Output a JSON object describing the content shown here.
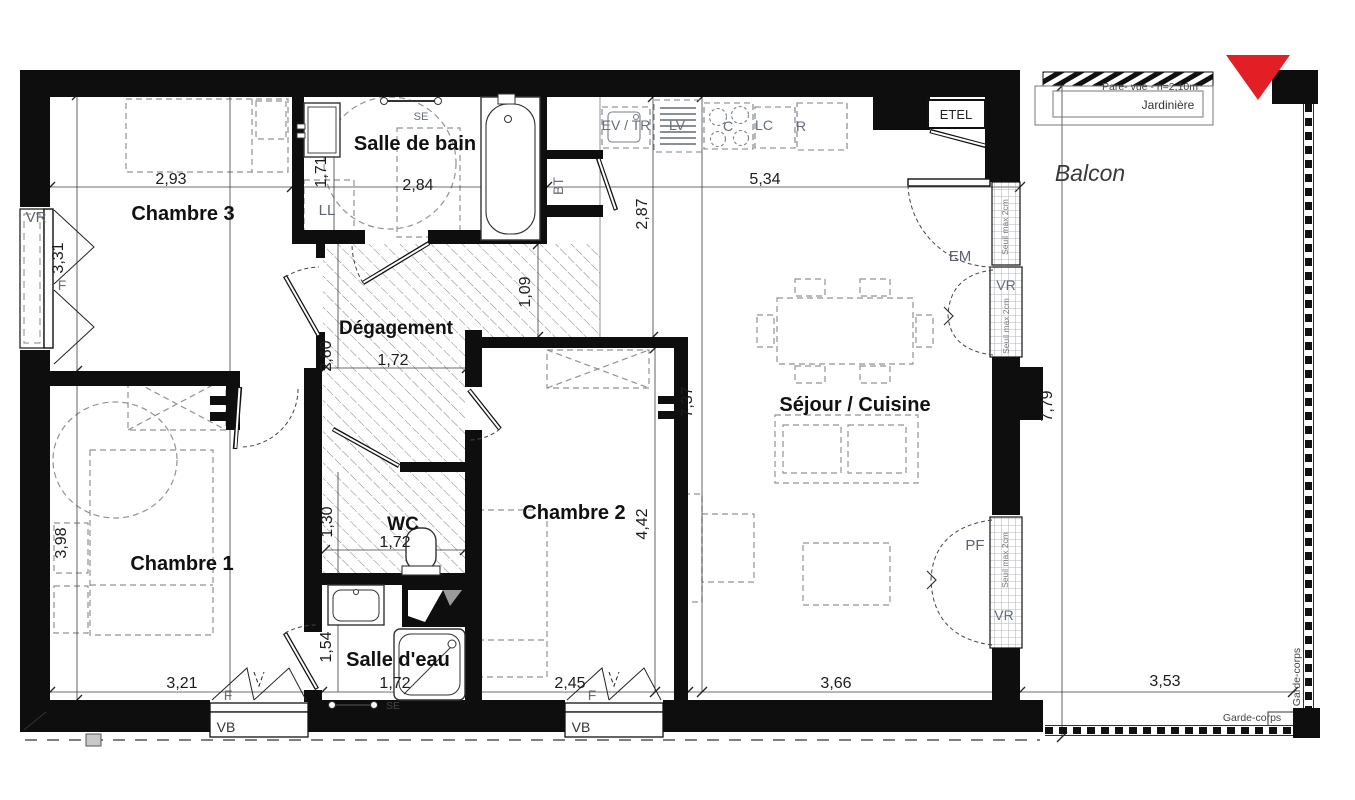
{
  "rooms": {
    "chambre3": "Chambre 3",
    "salle_de_bain": "Salle de bain",
    "degagement": "Dégagement",
    "chambre1": "Chambre 1",
    "wc": "WC",
    "chambre2": "Chambre 2",
    "salle_deau": "Salle d'eau",
    "sejour_cuisine": "Séjour / Cuisine",
    "balcon": "Balcon"
  },
  "dimensions": {
    "ch3_w": "2,93",
    "ch3_h": "3,31",
    "sdb_w": "2,84",
    "sdb_h": "1,71",
    "kitchen_w": "5,34",
    "kitchen_h": "2,87",
    "deg_w": "1,72",
    "deg_h": "2,60",
    "deg_h2": "1,09",
    "sejour_h": "7,37",
    "balcon_h": "7,79",
    "ch1_w": "3,21",
    "ch1_h": "3,98",
    "wc_w": "1,72",
    "wc_h": "1,30",
    "ch2_w": "2,45",
    "ch2_h": "4,42",
    "sde_w": "1,72",
    "sde_h": "1,54",
    "sejour_w": "3,66",
    "balcon_w": "3,53"
  },
  "fixtures": {
    "vr_left": "VR",
    "f_left": "F",
    "ll": "LL",
    "se_sdb": "SE",
    "bt": "BT",
    "ev_tr": "EV / TR",
    "lv": "LV",
    "c": "C",
    "lc": "LC",
    "r": "R",
    "etel": "ETEL",
    "em": "EM",
    "vr_right_top": "VR",
    "vr_right_bottom": "VR",
    "pf": "PF",
    "seuil_top": "Seuil max 2cm",
    "seuil_mid": "Seuil max 2cm",
    "seuil_bottom": "Seuil max 2cm",
    "f_bottom1": "F",
    "vb1": "VB",
    "f_bottom2": "F",
    "vb2": "VB",
    "se_sde": "SE"
  },
  "balcony": {
    "pare_vue": "Pare- vue - h=2,10m",
    "jardiniere": "Jardinière",
    "garde_corps_bottom": "Garde-corps",
    "garde_corps_right": "Garde-corps"
  },
  "colors": {
    "wall": "#0e0e0e",
    "north_marker": "#e31e24",
    "dim_text": "#1c1c1c",
    "fixture_text": "#666d78"
  }
}
